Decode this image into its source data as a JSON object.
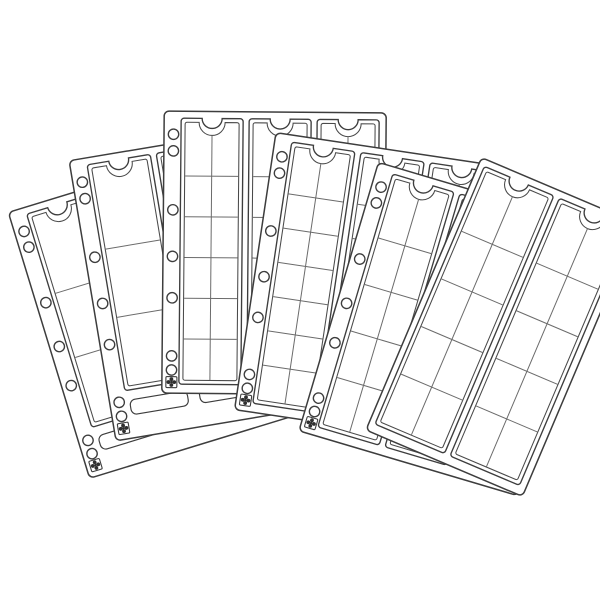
{
  "illustration": {
    "title": "Fanned coin album pocket pages (line-art product illustration)",
    "background_color": "#ffffff",
    "outline_color": "#3d3d3d",
    "inner_line_color": "#4a4a4a",
    "grid_line_color": "#6b6b6b",
    "mark_color": "#2f2f2f",
    "canvas": {
      "width": 600,
      "height": 600
    },
    "icons": {
      "binder-hole-icon": "round punched binder hole",
      "registration-mark-icon": "four-petal cross inside small square",
      "thumb-notch": "semicircular cutout at top of each pocket strip",
      "weld-seal": "thin rounded weld rectangle at strip bottom"
    },
    "hole_pattern": {
      "fractions": [
        0.082,
        0.141,
        0.35,
        0.515,
        0.662,
        0.868,
        0.918
      ],
      "cross_fraction": 0.961,
      "offset_x": 9.5,
      "radius": 5.2
    },
    "sheets": [
      {
        "id": "sheet-1",
        "cx": 158,
        "cy": 312,
        "w": 228,
        "h": 278,
        "angle": -17,
        "strips": 3,
        "cols": 1,
        "rows": 3,
        "margin": true,
        "weld": true
      },
      {
        "id": "sheet-2",
        "cx": 205,
        "cy": 282,
        "w": 228,
        "h": 284,
        "angle": -9.5,
        "strips": 3,
        "cols": 1,
        "rows": 3,
        "margin": true,
        "weld": true
      },
      {
        "id": "sheet-3",
        "cx": 274,
        "cy": 253,
        "w": 222,
        "h": 282,
        "angle": 0.5,
        "strips": 3,
        "cols": 2,
        "rows": 6,
        "margin": true,
        "weld": false
      },
      {
        "id": "sheet-4",
        "cx": 368,
        "cy": 288,
        "w": 228,
        "h": 280,
        "angle": 8.5,
        "strips": 3,
        "cols": 2,
        "rows": 7,
        "margin": true,
        "weld": false
      },
      {
        "id": "sheet-5",
        "cx": 448,
        "cy": 329,
        "w": 228,
        "h": 280,
        "angle": 16.5,
        "strips": 3,
        "cols": 2,
        "rows": 5,
        "margin": true,
        "weld": false
      },
      {
        "id": "sheet-6",
        "cx": 502,
        "cy": 327,
        "w": 170,
        "h": 296,
        "angle": 23,
        "strips": 2,
        "cols": 2,
        "rows": 5,
        "margin": false,
        "weld": false
      }
    ],
    "geometry": {
      "sheet_corner_radius": 5,
      "margin_width": 17,
      "right_pad": 7,
      "strip_gap": 6,
      "strip_top": 7,
      "notch_radius_outer": 10,
      "notch_radius_inner": 13,
      "inner_inset": 4
    }
  }
}
